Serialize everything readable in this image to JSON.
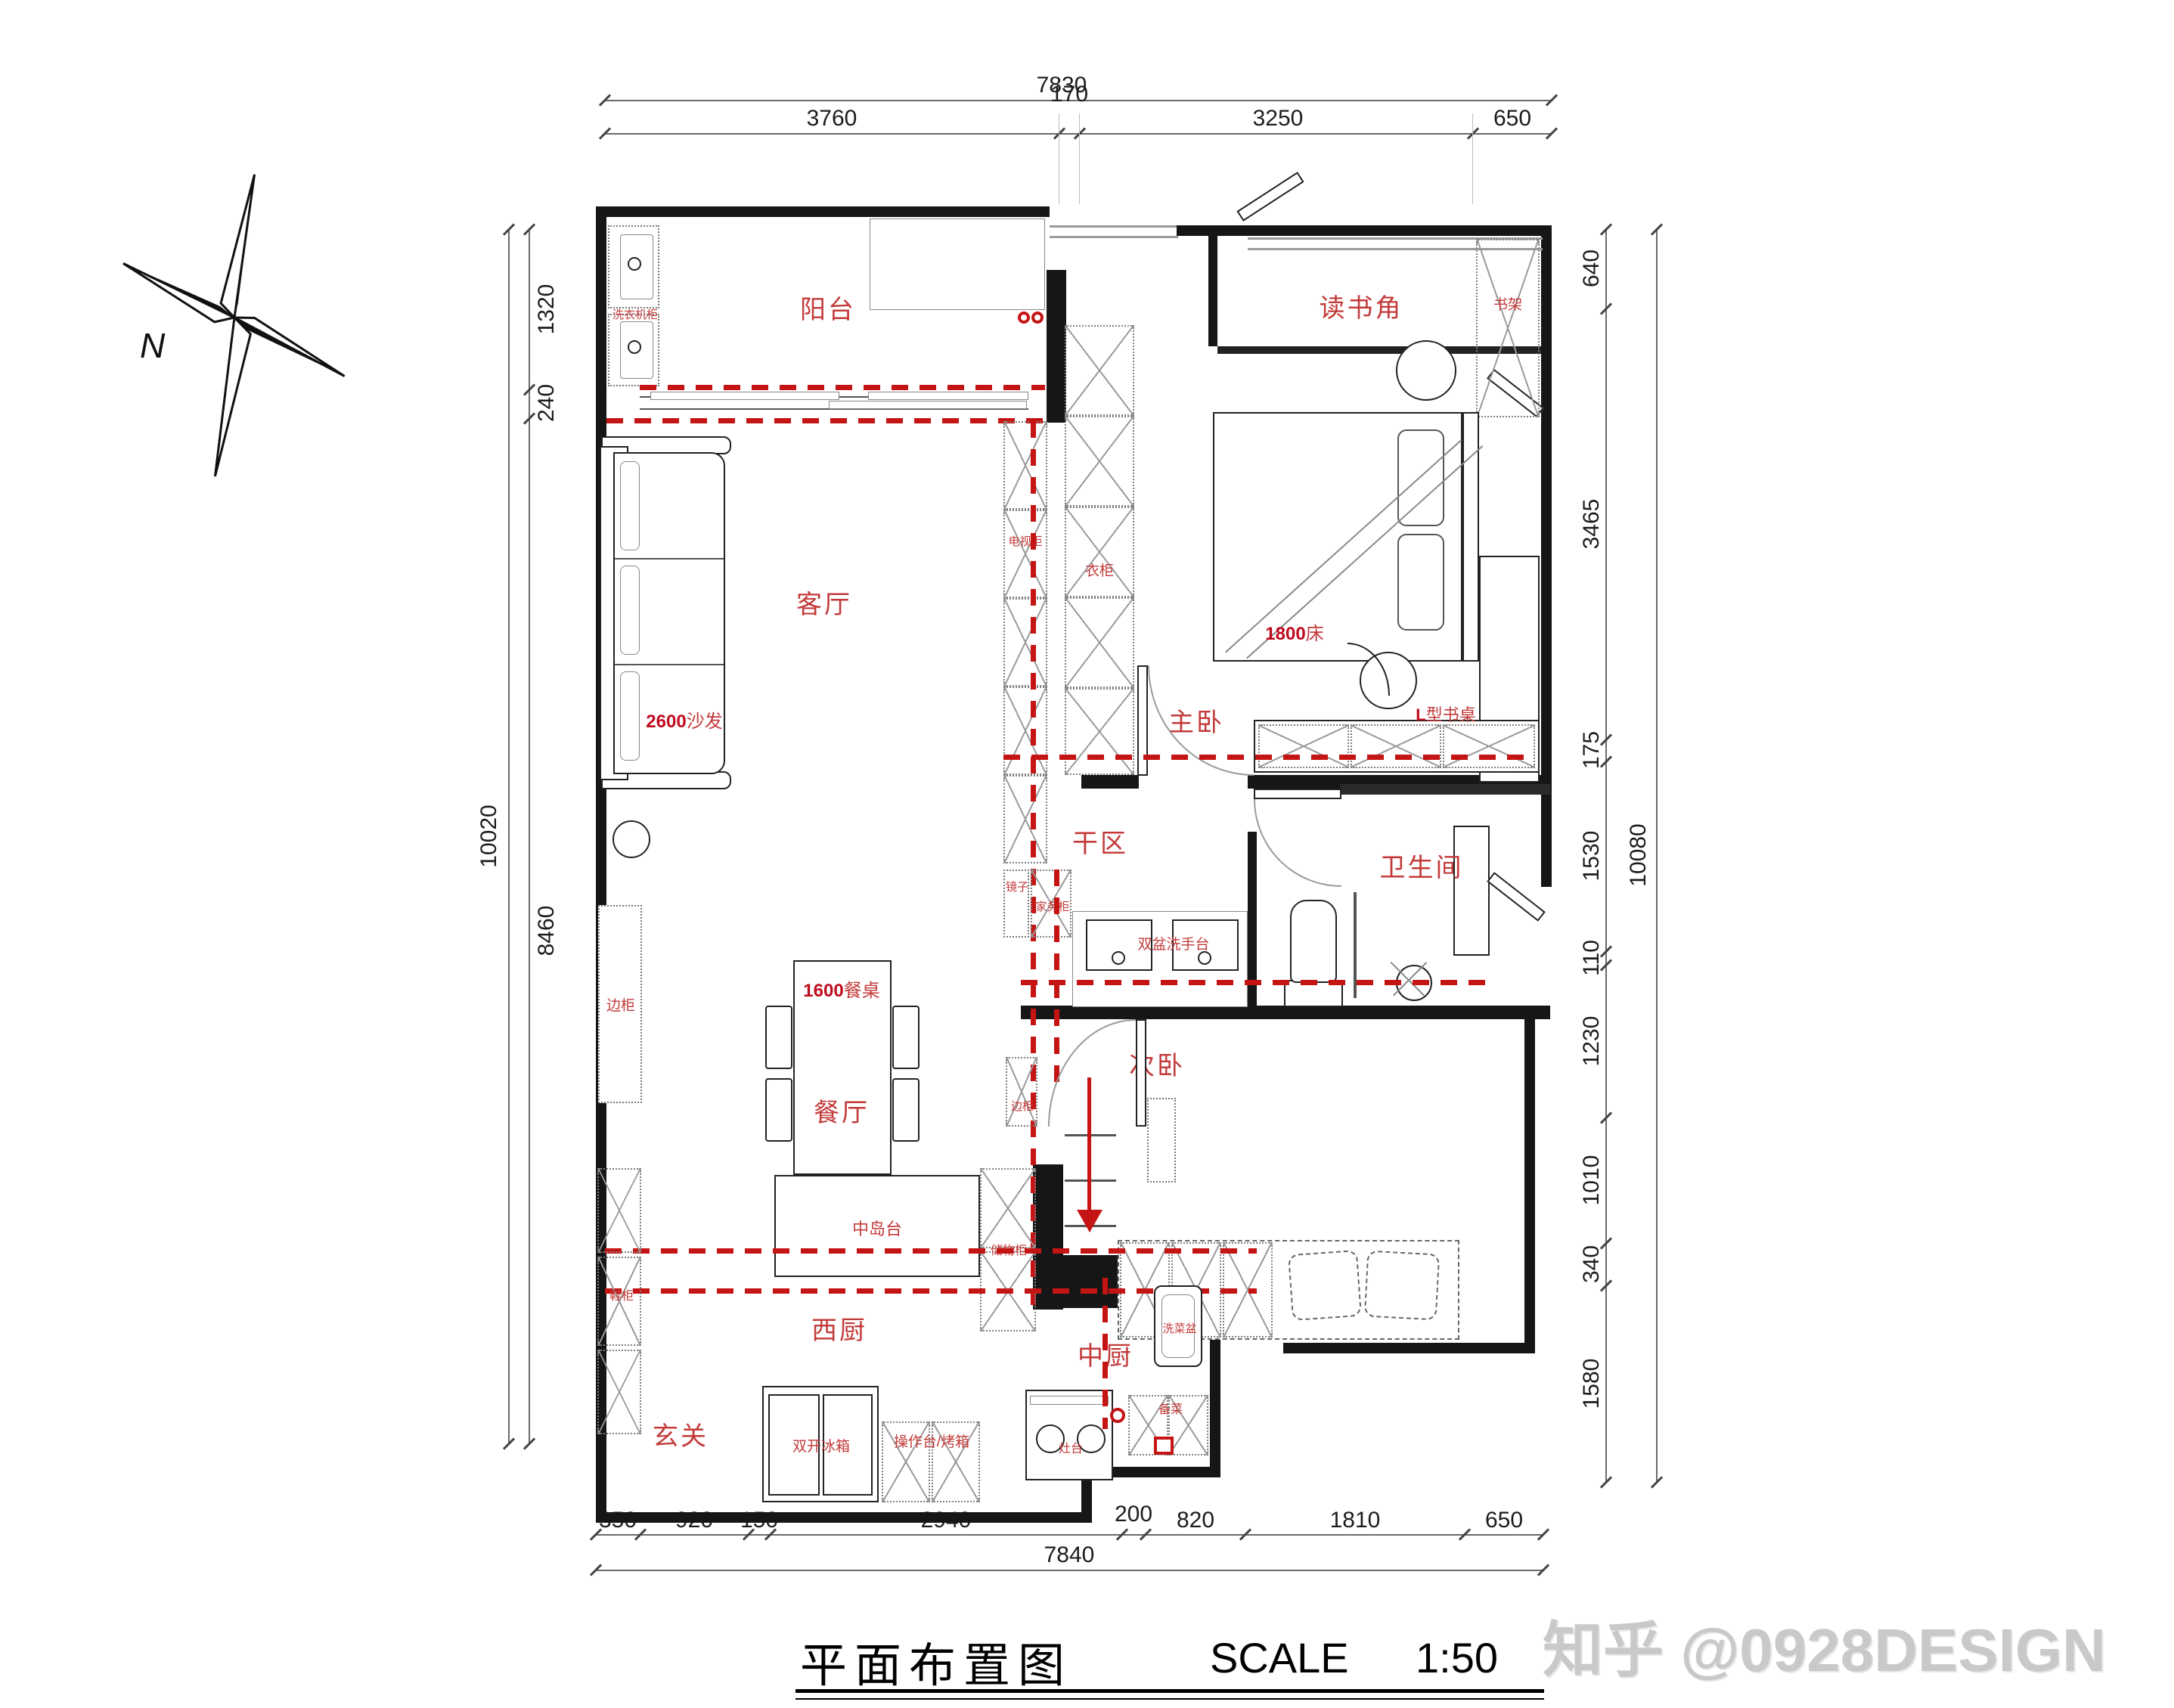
{
  "meta": {
    "title": "平面布置图",
    "scale_label": "SCALE",
    "scale_value": "1:50",
    "watermark": "知乎 @0928DESIGN",
    "compass_north": "N"
  },
  "dims": {
    "top": {
      "total": "7830",
      "segments": [
        "3760",
        "170",
        "3250",
        "650"
      ]
    },
    "bottom": {
      "total": "7840",
      "segments": [
        "350",
        "920",
        "150",
        "2940",
        "200",
        "820",
        "1810",
        "650"
      ]
    },
    "left": {
      "total": "10020",
      "segments": [
        "1320",
        "240",
        "8460"
      ]
    },
    "right": {
      "total": "10080",
      "segments": [
        "640",
        "3465",
        "175",
        "1530",
        "110",
        "1230",
        "1010",
        "340",
        "1580"
      ]
    }
  },
  "rooms": {
    "balcony": "阳台",
    "living": "客厅",
    "dining": "餐厅",
    "foyer": "玄关",
    "west_kitchen": "西厨",
    "chinese_kitchen": "中厨",
    "dry_area": "干区",
    "bathroom": "卫生间",
    "master_bedroom": "主卧",
    "second_bedroom": "次卧",
    "reading_nook": "读书角"
  },
  "furniture": {
    "washer_cabinet": "洗衣机柜",
    "sofa_num": "2600",
    "sofa": "沙发",
    "tv_cabinet": "电视柜",
    "wardrobe": "衣柜",
    "bed_num": "1800",
    "bed": "床",
    "desk_num": "L",
    "desk": "型书桌",
    "bookshelf": "书架",
    "mirror": "镜子",
    "utility_cabinet": "家务柜",
    "double_basin": "双盆洗手台",
    "table_num": "1600",
    "table": "餐桌",
    "side_cabinet_left": "边柜",
    "side_cabinet_right": "边柜",
    "island": "中岛台",
    "storage": "储物柜",
    "shoe_cabinet": "鞋柜",
    "fridge": "双开冰箱",
    "counter_oven": "操作台/烤箱",
    "stove": "灶台",
    "veg_sink": "洗菜盆",
    "prep": "备菜"
  },
  "colors": {
    "label_red": "#C33A3A",
    "dash_red": "#C51414",
    "wall_black": "#161616",
    "watermark_gray": "#C9C9C9"
  }
}
